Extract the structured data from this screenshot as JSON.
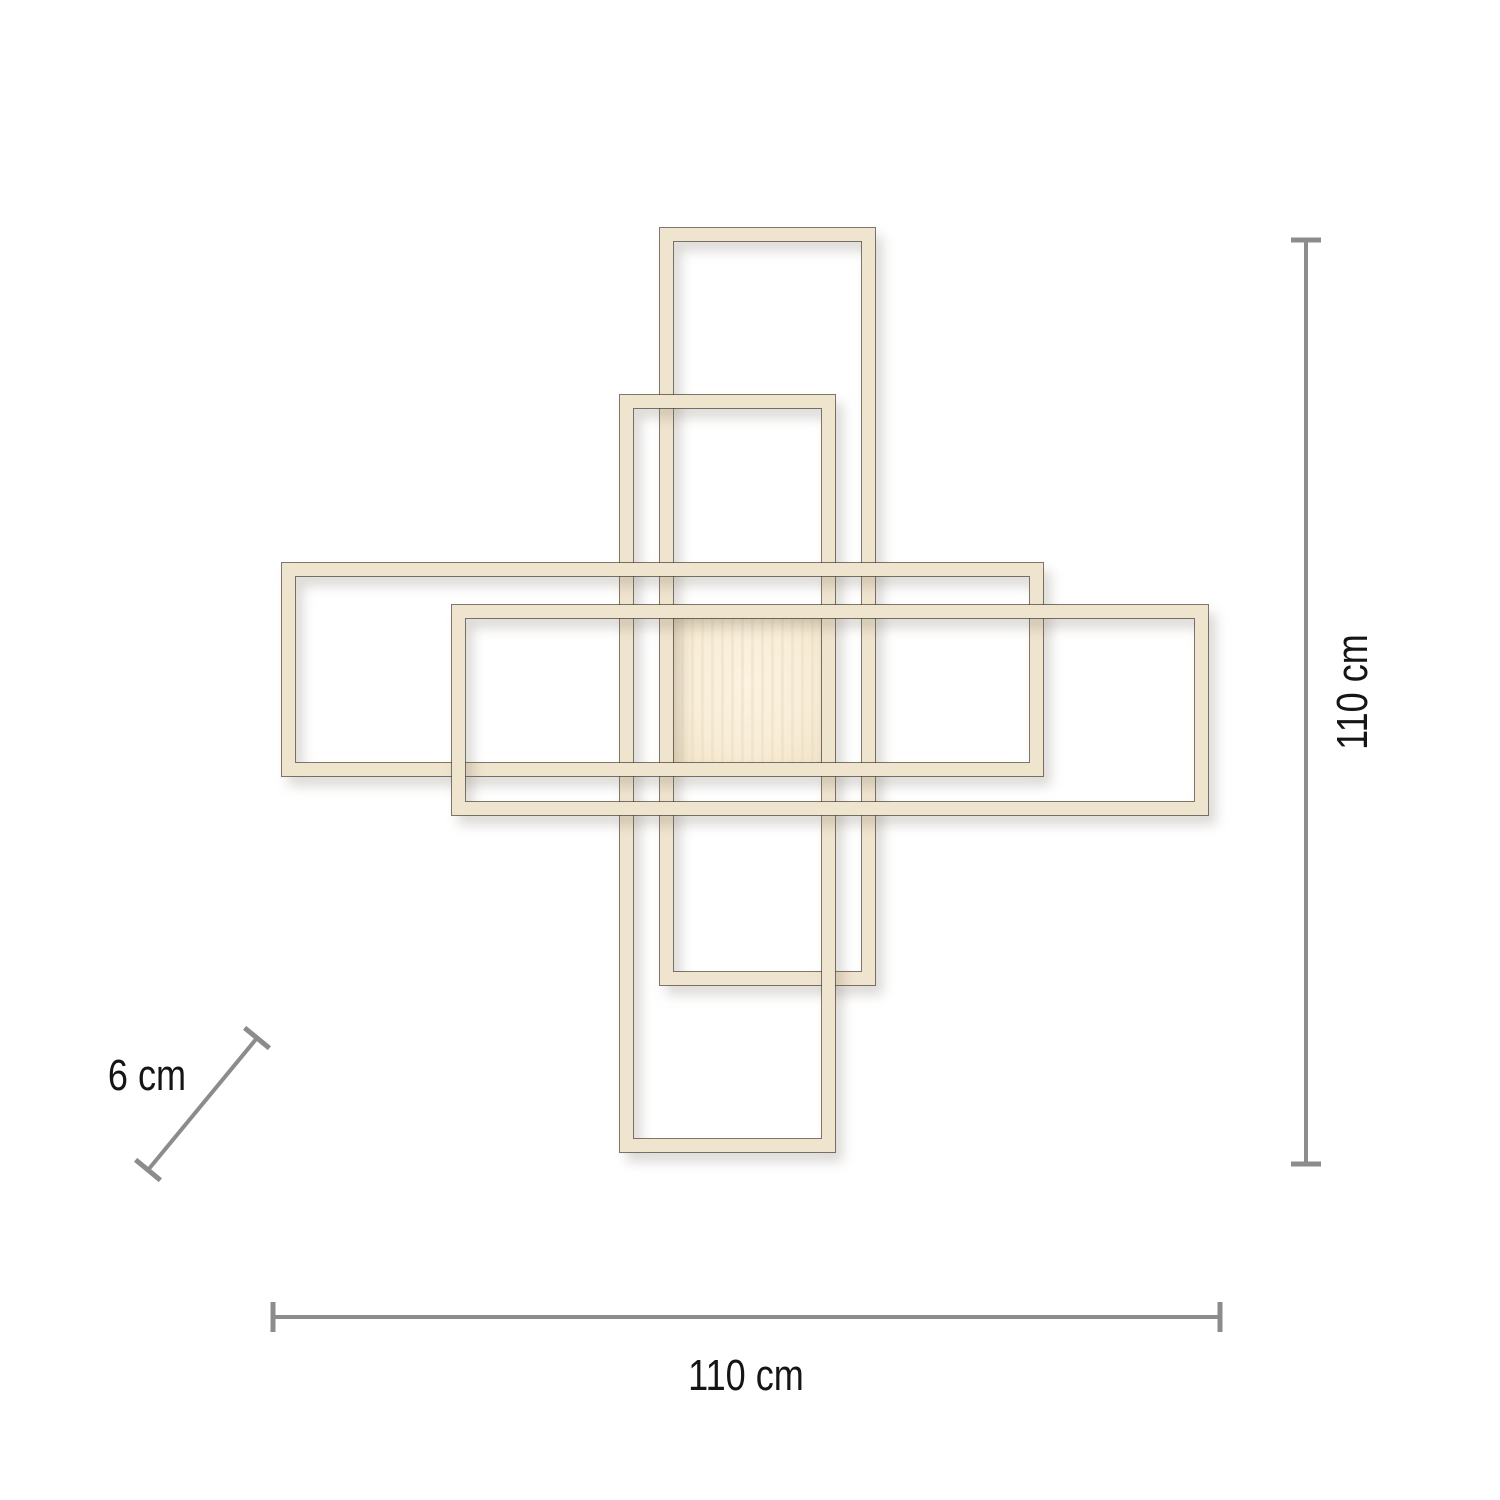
{
  "diagram": {
    "type": "product-dimension-drawing",
    "background_color": "#ffffff",
    "lamp": {
      "frame_fill_color": "#efe4ce",
      "frame_edge_color": "#4b4236",
      "panel_fill_color": "#f8edd8",
      "frame_count": 4
    },
    "dimensions": {
      "line_color": "#8c8c8c",
      "text_color": "#151515",
      "height": {
        "label": "110 cm"
      },
      "width": {
        "label": "110 cm"
      },
      "depth": {
        "label": "6 cm"
      }
    }
  }
}
